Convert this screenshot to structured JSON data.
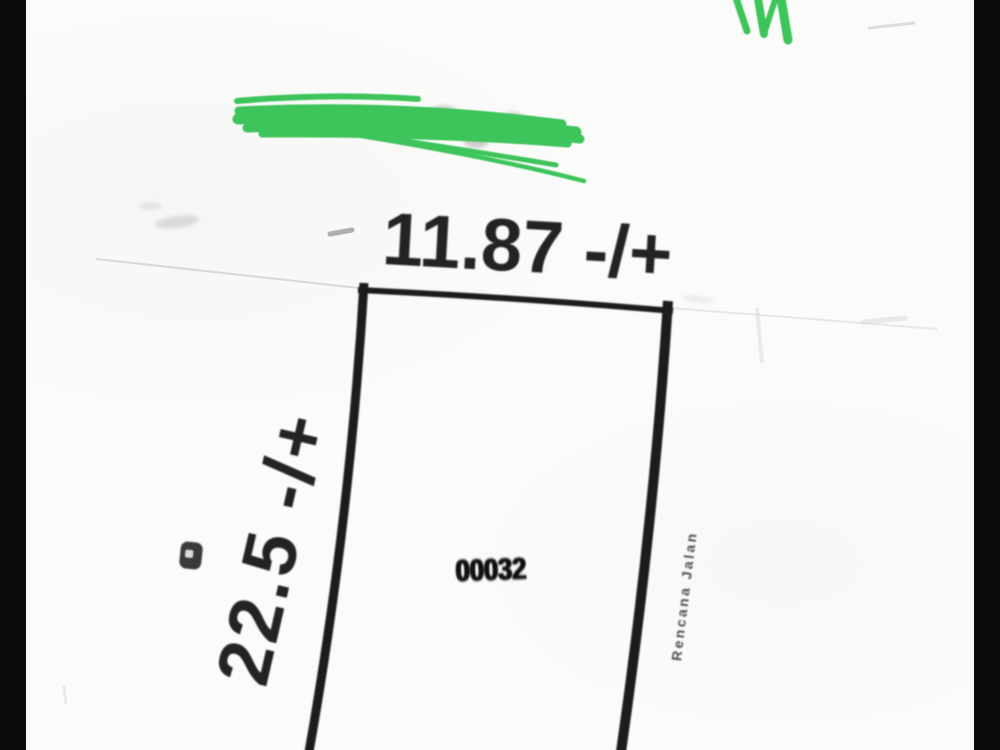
{
  "drawing": {
    "top_dimension_label": "11.87 -/+",
    "left_dimension_label": "22.5 -/+",
    "plot_number": "00032",
    "right_side_label": "Rencana Jalan"
  },
  "colors": {
    "background": "#070707",
    "paper": "#fbfbfa",
    "ink": "#1a1a1a",
    "highlighter_green": "#3ec45a",
    "faint_gray": "#c8c8c8"
  }
}
